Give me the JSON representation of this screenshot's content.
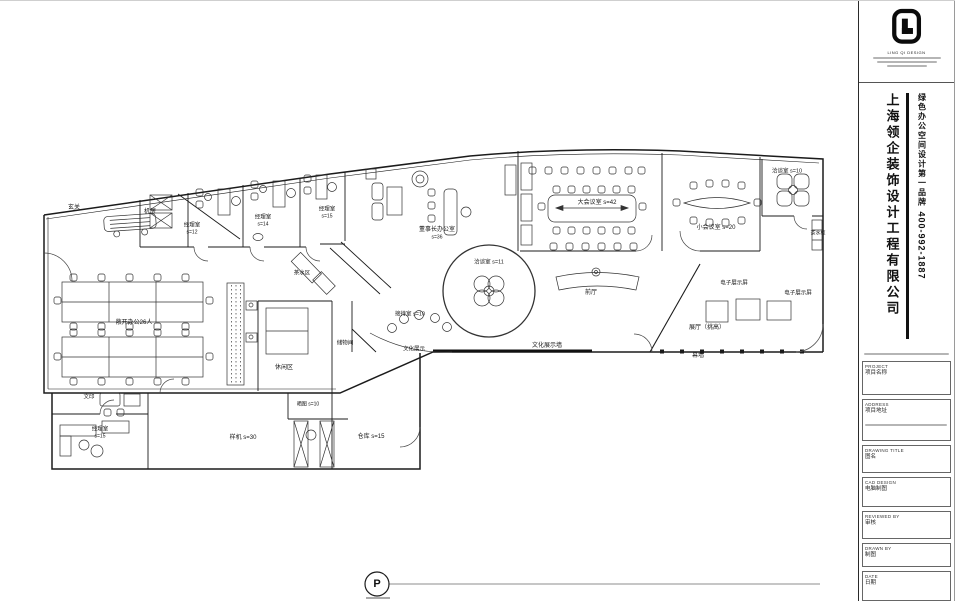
{
  "plan": {
    "p_marker": {
      "letter": "P"
    },
    "labels": [
      {
        "t": "玄关",
        "x": 74,
        "y": 207,
        "fs": 6
      },
      {
        "t": "机房",
        "x": 150,
        "y": 211,
        "fs": 6
      },
      {
        "t": "经理室",
        "x": 192,
        "y": 225,
        "fs": 5.5
      },
      {
        "t": "s=12",
        "x": 192,
        "y": 232,
        "fs": 5
      },
      {
        "t": "经理室",
        "x": 263,
        "y": 217,
        "fs": 5.5
      },
      {
        "t": "s=14",
        "x": 263,
        "y": 224,
        "fs": 5
      },
      {
        "t": "经理室",
        "x": 327,
        "y": 209,
        "fs": 5.5
      },
      {
        "t": "s=15",
        "x": 327,
        "y": 216,
        "fs": 5
      },
      {
        "t": "董事长办公室",
        "x": 437,
        "y": 229,
        "fs": 6
      },
      {
        "t": "s=36",
        "x": 437,
        "y": 237,
        "fs": 5
      },
      {
        "t": "茶水区",
        "x": 302,
        "y": 273,
        "fs": 5.5
      },
      {
        "t": "大会议室 s=42",
        "x": 597,
        "y": 202,
        "fs": 6
      },
      {
        "t": "小会议室 s=20",
        "x": 716,
        "y": 227,
        "fs": 6
      },
      {
        "t": "洽谈室 s=10",
        "x": 787,
        "y": 171,
        "fs": 5.5
      },
      {
        "t": "茶水柜",
        "x": 818,
        "y": 233,
        "fs": 5
      },
      {
        "t": "洽谈室 s=11",
        "x": 489,
        "y": 262,
        "fs": 5.5
      },
      {
        "t": "前厅",
        "x": 591,
        "y": 292,
        "fs": 6
      },
      {
        "t": "电子展示屏",
        "x": 734,
        "y": 283,
        "fs": 5.5
      },
      {
        "t": "电子展示屏",
        "x": 798,
        "y": 293,
        "fs": 5.5
      },
      {
        "t": "展厅（挑高）",
        "x": 707,
        "y": 327,
        "fs": 6
      },
      {
        "t": "幕墙",
        "x": 698,
        "y": 355,
        "fs": 6
      },
      {
        "t": "文化展示墙",
        "x": 547,
        "y": 345,
        "fs": 6
      },
      {
        "t": "接待室 s=10",
        "x": 410,
        "y": 314,
        "fs": 5.5
      },
      {
        "t": "储物间",
        "x": 345,
        "y": 343,
        "fs": 5.5
      },
      {
        "t": "文化展示",
        "x": 414,
        "y": 349,
        "fs": 5.5
      },
      {
        "t": "休闲区",
        "x": 284,
        "y": 367,
        "fs": 6
      },
      {
        "t": "敞开办公26人",
        "x": 134,
        "y": 322,
        "fs": 6
      },
      {
        "t": "文印",
        "x": 89,
        "y": 397,
        "fs": 5.5
      },
      {
        "t": "经理室",
        "x": 100,
        "y": 429,
        "fs": 5.5
      },
      {
        "t": "s=15",
        "x": 100,
        "y": 436,
        "fs": 5
      },
      {
        "t": "样机 s=30",
        "x": 243,
        "y": 437,
        "fs": 6
      },
      {
        "t": "晒图 s=10",
        "x": 308,
        "y": 404,
        "fs": 5
      },
      {
        "t": "仓库 s=15",
        "x": 371,
        "y": 436,
        "fs": 6
      }
    ]
  },
  "titleblock": {
    "brand": "LING QI DESIGN",
    "company": "上海领企装饰设计工程有限公司",
    "slogan": "绿色办公空间设计第一品牌",
    "phone": "400-992-1887",
    "fields": [
      {
        "en": "PROJECT",
        "zh": "项目名称"
      },
      {
        "en": "ADDRESS",
        "zh": "项目地址"
      },
      {
        "en": "DRAWING TITLE",
        "zh": "图名"
      },
      {
        "en": "CAD DESIGN",
        "zh": "电脑制图"
      },
      {
        "en": "REVIEWED BY",
        "zh": "审核"
      },
      {
        "en": "DRAWN BY",
        "zh": "制图"
      },
      {
        "en": "DATE",
        "zh": "日期"
      }
    ]
  },
  "colors": {
    "line": "#1b1b1b",
    "background": "#ffffff"
  }
}
